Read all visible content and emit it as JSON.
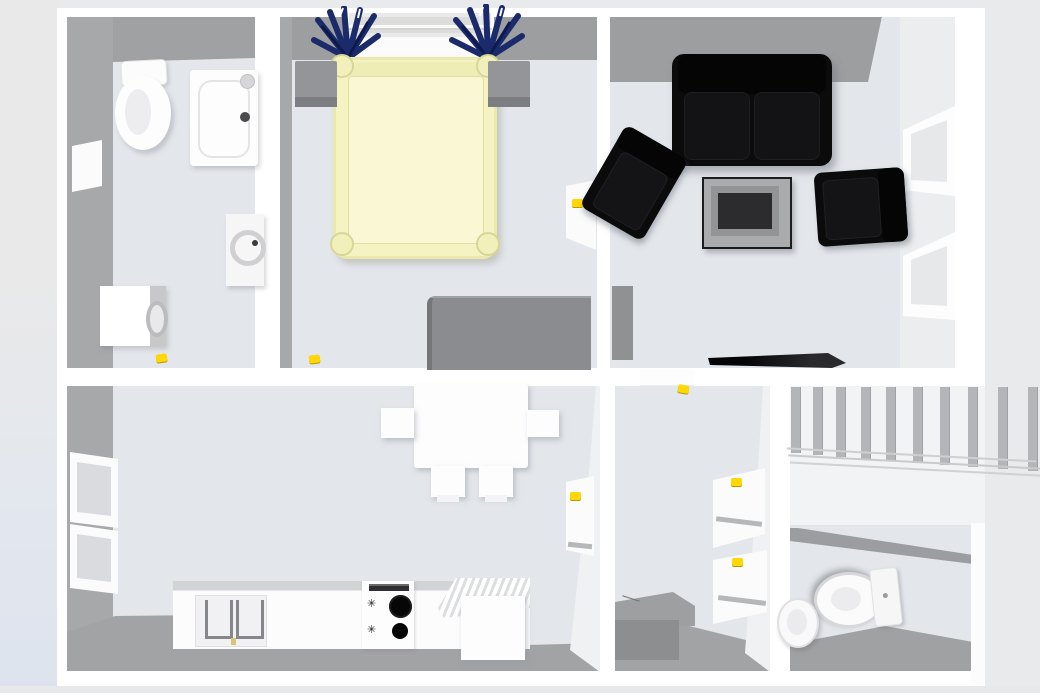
{
  "view": {
    "type": "3d-floor-plan-overhead",
    "description": "Overhead 3D rendering of a furnished one-floor apartment",
    "background_color": "#e9eaec",
    "floor_color": "#e3e6eb",
    "wall_top_color": "#ffffff",
    "wall_inner_face_color": "#a2a3a5",
    "door_handle_color": "#ffd704"
  },
  "rooms": [
    {
      "name": "bathroom",
      "position": "top-left",
      "furniture": [
        "toilet",
        "shower-tray",
        "wall-cabinet",
        "washing-machine"
      ],
      "doors": 1
    },
    {
      "name": "bedroom",
      "position": "top-middle",
      "furniture": [
        "double-bed",
        "nightstand-left",
        "nightstand-right",
        "dresser",
        "window-with-curtains"
      ],
      "bed_color": "#f5f3c2",
      "curtain_color": "#1b2a6a",
      "doors": 1
    },
    {
      "name": "living-room",
      "position": "top-right",
      "furniture": [
        "sofa-two-seat",
        "armchair-left",
        "armchair-right",
        "coffee-table",
        "flat-tv",
        "radiator",
        "window-1",
        "window-2"
      ],
      "seating_color": "#0b0b0c"
    },
    {
      "name": "kitchen",
      "position": "bottom-left",
      "furniture": [
        "dining-table",
        "chair-left",
        "chair-right",
        "chair-bottom-1",
        "chair-bottom-2",
        "counter-double-sink",
        "stove-two-burners",
        "base-cabinet",
        "window-1",
        "window-2"
      ],
      "doors": 1
    },
    {
      "name": "hallway",
      "position": "bottom-middle",
      "furniture": [
        "storage-bench",
        "door-top",
        "door-right-1",
        "door-right-2"
      ]
    },
    {
      "name": "staircase",
      "position": "right",
      "balusters": 10
    },
    {
      "name": "wc",
      "position": "bottom-right",
      "furniture": [
        "toilet",
        "sink"
      ]
    }
  ],
  "door_handles": {
    "color": "#ffd704",
    "count": 7
  },
  "stove": {
    "burners": 2,
    "knob_glyph": "✳"
  }
}
